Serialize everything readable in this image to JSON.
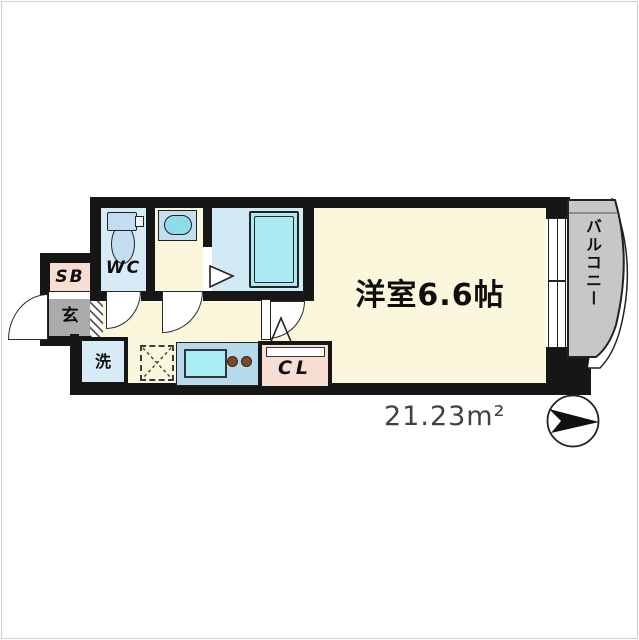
{
  "floor_plan": {
    "main_room": "洋室6.6帖",
    "wc": "WC",
    "shoe_box": "SB",
    "entrance": "玄",
    "laundry": "洗",
    "closet": "CL",
    "balcony": "バルコニー",
    "total_area": "21.23m²"
  },
  "icons": {
    "toilet": "toilet-icon",
    "wash_basin": "wash-basin-icon",
    "bathtub": "bathtub-icon",
    "kitchen_sink": "kitchen-sink-icon",
    "stove_burners": "stove-burner-icon",
    "fridge_space": "fridge-space-dashed-box",
    "north_arrow": "north-arrow-icon"
  },
  "colors": {
    "wall": "#161616",
    "cream": "#fbf7dc",
    "room-blue": "#d7ebf7",
    "bath-blue": "#d2eaf4",
    "tub-cyan": "#abe9f3",
    "counter-blue": "#b6daec",
    "sink-cyan": "#a9edf6",
    "fixture-blue": "#c3ddf1",
    "basin-cyan": "#8edcea",
    "pink": "#f8ddd3",
    "gray-genkan": "#ababab",
    "gray-balcony": "#c7c7c7",
    "burner-brown": "#7a4a28",
    "area-text": "#414141"
  }
}
